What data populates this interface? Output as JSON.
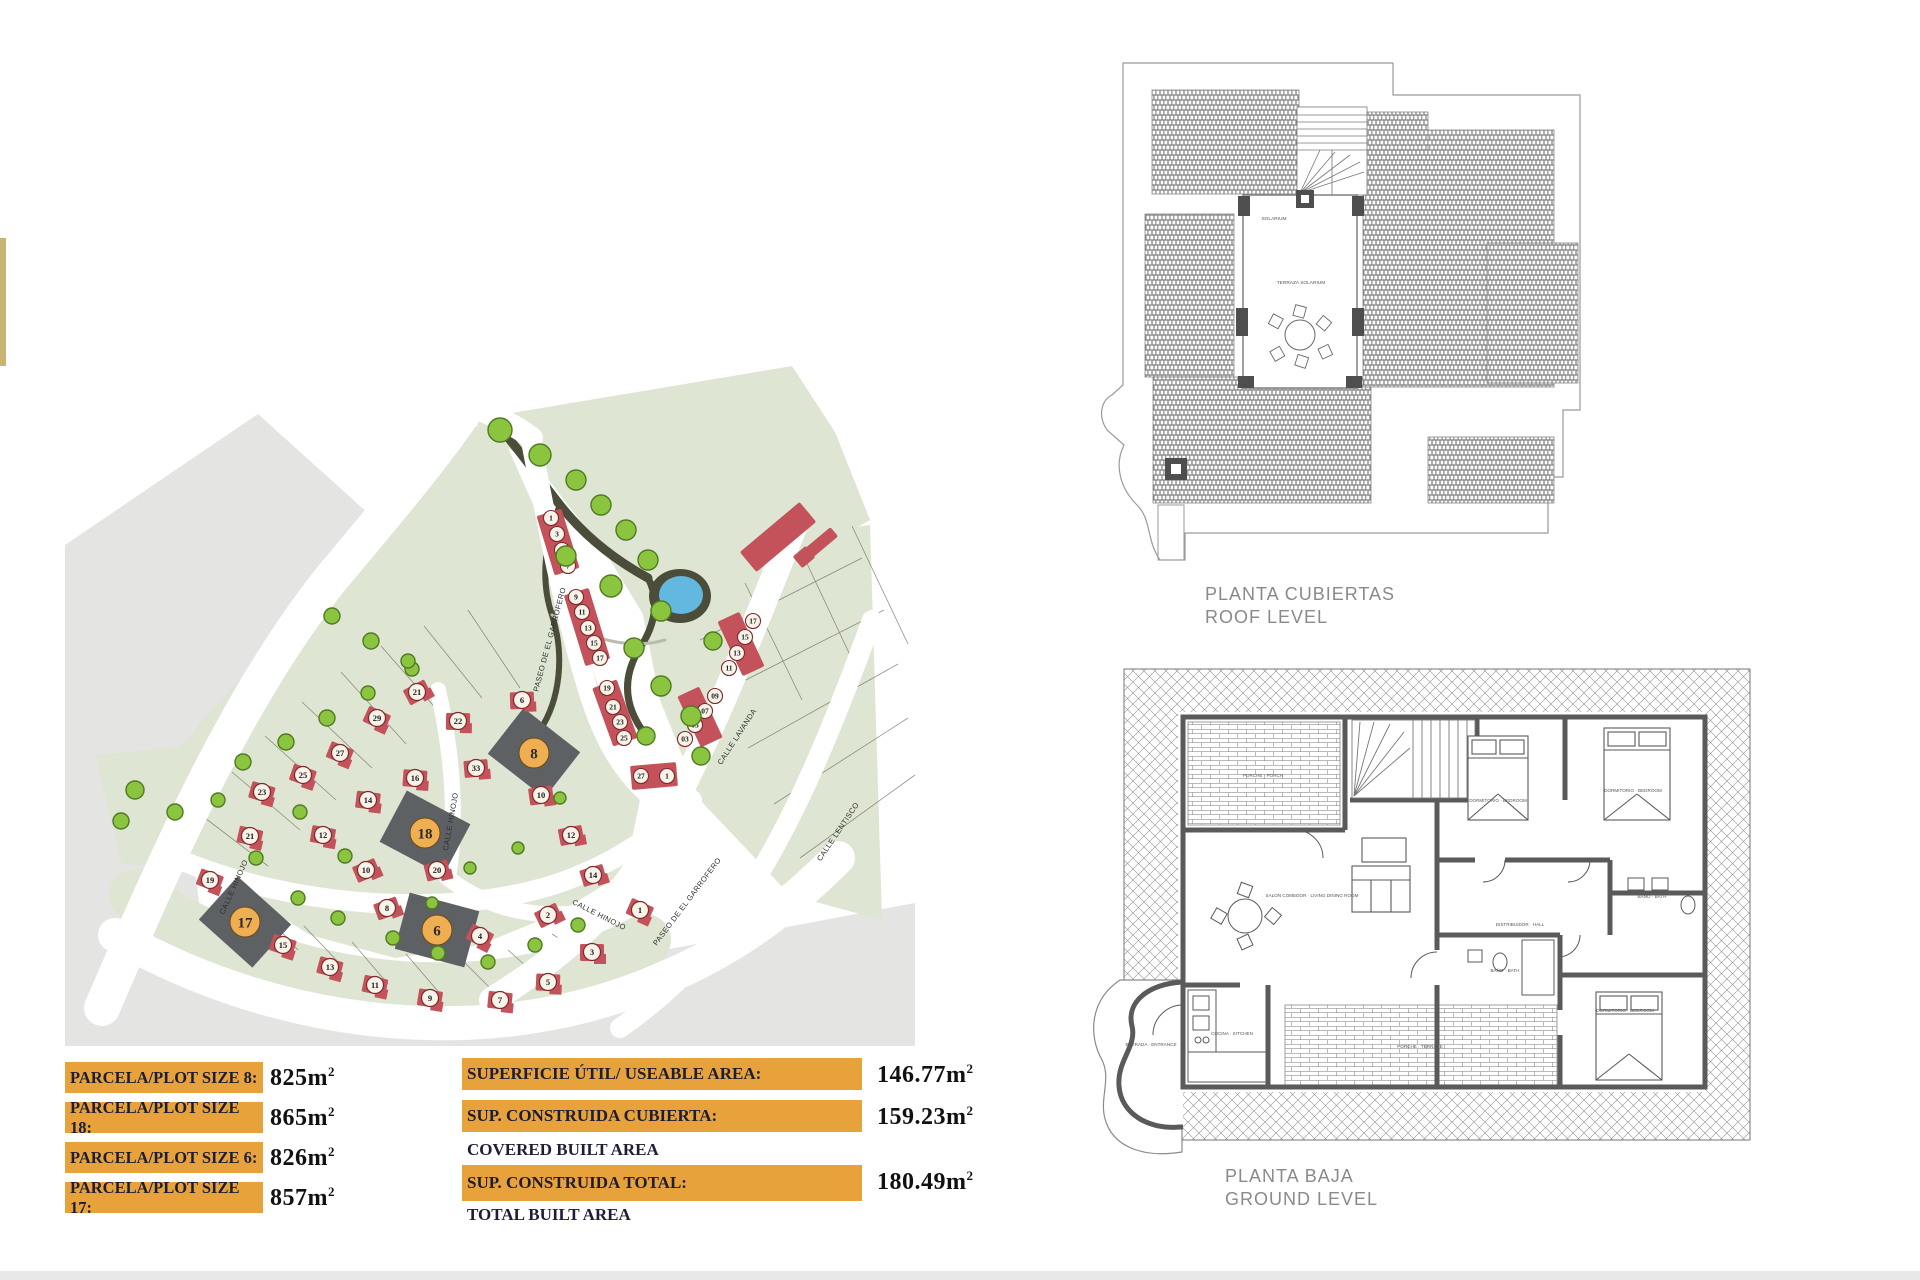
{
  "colors": {
    "terrain_gray": "#e4e4e2",
    "green": "#dee5d2",
    "green_edge": "#c9d2bc",
    "road_white": "#ffffff",
    "house_red": "#c4525a",
    "circle_fill": "#f8f3e9",
    "circle_stroke": "#7c2a2e",
    "highlight_plot": "#5d6164",
    "orange_circle": "#f0ae53",
    "tree": "#8bc53f",
    "tree_stroke": "#4f7a23",
    "park_dark": "#4b4c39",
    "pond_blue": "#62b8df",
    "table_orange": "#e8a23b",
    "plan_line": "#8e8e8e",
    "wall": "#5a5a5a"
  },
  "site_plan": {
    "street_labels": [
      {
        "text": "PASEO DE EL GARROFERO",
        "x": 552,
        "y": 640,
        "rot": -75
      },
      {
        "text": "CALLE HINOJO",
        "x": 453,
        "y": 822,
        "rot": -80
      },
      {
        "text": "CALLE HINOJO",
        "x": 236,
        "y": 888,
        "rot": -66
      },
      {
        "text": "CALLE HINOJO",
        "x": 598,
        "y": 917,
        "rot": 27
      },
      {
        "text": "CALLE LAVANDA",
        "x": 739,
        "y": 738,
        "rot": -57
      },
      {
        "text": "CALLE LENTISCO",
        "x": 840,
        "y": 833,
        "rot": -56
      },
      {
        "text": "PASEO DE EL GARROFERO",
        "x": 689,
        "y": 903,
        "rot": -53
      }
    ],
    "highlight_plots": [
      {
        "n": "8",
        "x": 534,
        "y": 753,
        "rot": 38
      },
      {
        "n": "18",
        "x": 425,
        "y": 833,
        "rot": 28
      },
      {
        "n": "6",
        "x": 437,
        "y": 930,
        "rot": 15
      },
      {
        "n": "17",
        "x": 245,
        "y": 922,
        "rot": 42
      }
    ],
    "townhouse_units": [
      {
        "n": "1",
        "x": 551,
        "y": 518
      },
      {
        "n": "3",
        "x": 557,
        "y": 534
      },
      {
        "n": "5",
        "x": 562,
        "y": 550
      },
      {
        "n": "7",
        "x": 568,
        "y": 566
      },
      {
        "n": "9",
        "x": 576,
        "y": 597
      },
      {
        "n": "11",
        "x": 582,
        "y": 612
      },
      {
        "n": "13",
        "x": 588,
        "y": 628
      },
      {
        "n": "15",
        "x": 594,
        "y": 643
      },
      {
        "n": "17",
        "x": 600,
        "y": 658
      },
      {
        "n": "19",
        "x": 607,
        "y": 688
      },
      {
        "n": "21",
        "x": 613,
        "y": 707
      },
      {
        "n": "23",
        "x": 620,
        "y": 722
      },
      {
        "n": "25",
        "x": 624,
        "y": 738
      },
      {
        "n": "27",
        "x": 641,
        "y": 776
      },
      {
        "n": "1",
        "x": 667,
        "y": 776
      },
      {
        "n": "17",
        "x": 753,
        "y": 621
      },
      {
        "n": "15",
        "x": 745,
        "y": 637
      },
      {
        "n": "13",
        "x": 737,
        "y": 653
      },
      {
        "n": "11",
        "x": 729,
        "y": 668
      },
      {
        "n": "09",
        "x": 715,
        "y": 696
      },
      {
        "n": "07",
        "x": 705,
        "y": 711
      },
      {
        "n": "05",
        "x": 695,
        "y": 725
      },
      {
        "n": "03",
        "x": 685,
        "y": 739
      }
    ],
    "houses": [
      {
        "n": "21",
        "x": 417,
        "y": 692
      },
      {
        "n": "29",
        "x": 377,
        "y": 718
      },
      {
        "n": "27",
        "x": 340,
        "y": 753
      },
      {
        "n": "25",
        "x": 303,
        "y": 775
      },
      {
        "n": "23",
        "x": 262,
        "y": 792
      },
      {
        "n": "21",
        "x": 250,
        "y": 836
      },
      {
        "n": "12",
        "x": 323,
        "y": 835
      },
      {
        "n": "14",
        "x": 368,
        "y": 800
      },
      {
        "n": "16",
        "x": 415,
        "y": 778
      },
      {
        "n": "22",
        "x": 458,
        "y": 721
      },
      {
        "n": "6",
        "x": 522,
        "y": 700
      },
      {
        "n": "33",
        "x": 476,
        "y": 768
      },
      {
        "n": "10",
        "x": 541,
        "y": 795
      },
      {
        "n": "12",
        "x": 571,
        "y": 835
      },
      {
        "n": "20",
        "x": 437,
        "y": 870
      },
      {
        "n": "14",
        "x": 593,
        "y": 875
      },
      {
        "n": "8",
        "x": 387,
        "y": 908
      },
      {
        "n": "10",
        "x": 366,
        "y": 870
      },
      {
        "n": "2",
        "x": 548,
        "y": 915
      },
      {
        "n": "4",
        "x": 480,
        "y": 936
      },
      {
        "n": "1",
        "x": 640,
        "y": 910
      },
      {
        "n": "19",
        "x": 210,
        "y": 880
      },
      {
        "n": "15",
        "x": 283,
        "y": 945
      },
      {
        "n": "13",
        "x": 330,
        "y": 967
      },
      {
        "n": "11",
        "x": 375,
        "y": 985
      },
      {
        "n": "9",
        "x": 430,
        "y": 998
      },
      {
        "n": "7",
        "x": 500,
        "y": 1000
      },
      {
        "n": "5",
        "x": 548,
        "y": 982
      },
      {
        "n": "3",
        "x": 592,
        "y": 952
      }
    ],
    "blocks": [
      {
        "x": 558,
        "y": 542,
        "w": 26,
        "h": 62,
        "r": -17
      },
      {
        "x": 587,
        "y": 627,
        "w": 26,
        "h": 74,
        "r": -17
      },
      {
        "x": 615,
        "y": 713,
        "w": 26,
        "h": 62,
        "r": -20
      },
      {
        "x": 654,
        "y": 776,
        "w": 46,
        "h": 24,
        "r": -5
      },
      {
        "x": 741,
        "y": 644,
        "w": 24,
        "h": 60,
        "r": -25
      },
      {
        "x": 700,
        "y": 717,
        "w": 24,
        "h": 56,
        "r": -25
      },
      {
        "x": 778,
        "y": 537,
        "w": 78,
        "h": 26,
        "r": -40
      },
      {
        "x": 804,
        "y": 557,
        "w": 17,
        "h": 15,
        "r": -40
      },
      {
        "x": 822,
        "y": 542,
        "w": 32,
        "h": 12,
        "r": -40
      }
    ],
    "trees": [
      [
        500,
        430,
        12
      ],
      [
        540,
        455,
        11
      ],
      [
        576,
        480,
        10
      ],
      [
        601,
        505,
        10
      ],
      [
        626,
        530,
        10
      ],
      [
        566,
        556,
        10
      ],
      [
        648,
        560,
        10
      ],
      [
        611,
        586,
        11
      ],
      [
        661,
        611,
        10
      ],
      [
        634,
        648,
        10
      ],
      [
        661,
        686,
        10
      ],
      [
        691,
        716,
        10
      ],
      [
        646,
        736,
        9
      ],
      [
        701,
        756,
        9
      ],
      [
        713,
        641,
        9
      ],
      [
        243,
        762,
        8
      ],
      [
        286,
        742,
        8
      ],
      [
        327,
        718,
        8
      ],
      [
        368,
        693,
        7
      ],
      [
        412,
        669,
        7
      ],
      [
        300,
        812,
        7
      ],
      [
        256,
        858,
        7
      ],
      [
        345,
        856,
        7
      ],
      [
        298,
        898,
        7
      ],
      [
        338,
        918,
        7
      ],
      [
        393,
        938,
        7
      ],
      [
        438,
        953,
        7
      ],
      [
        488,
        962,
        7
      ],
      [
        535,
        945,
        7
      ],
      [
        578,
        925,
        7
      ],
      [
        432,
        903,
        6
      ],
      [
        470,
        868,
        6
      ],
      [
        518,
        848,
        6
      ],
      [
        560,
        798,
        6
      ],
      [
        135,
        790,
        9
      ],
      [
        175,
        812,
        8
      ],
      [
        121,
        821,
        8
      ],
      [
        218,
        800,
        7
      ],
      [
        332,
        616,
        8
      ],
      [
        371,
        641,
        8
      ],
      [
        408,
        661,
        7
      ]
    ]
  },
  "roof_plan": {
    "title_es": "PLANTA CUBIERTAS",
    "title_en": "ROOF LEVEL",
    "room_labels": [
      {
        "text": "SOLARIUM",
        "x": 1274,
        "y": 220
      },
      {
        "text": "TERRAZA SOLARIUM",
        "x": 1301,
        "y": 284
      }
    ]
  },
  "ground_plan": {
    "title_es": "PLANTA BAJA",
    "title_en": "GROUND LEVEL",
    "room_labels": [
      {
        "text": "PORCHE · PORCH",
        "x": 1263,
        "y": 777
      },
      {
        "text": "SALON COMEDOR · LIVING DINING ROOM",
        "x": 1312,
        "y": 897
      },
      {
        "text": "COCINA · KITCHEN",
        "x": 1232,
        "y": 1035
      },
      {
        "text": "ENTRADA · ENTRANCE",
        "x": 1151,
        "y": 1046
      },
      {
        "text": "DORMITORIO · BEDROOM",
        "x": 1498,
        "y": 802
      },
      {
        "text": "DORMITORIO · BEDROOM",
        "x": 1633,
        "y": 792
      },
      {
        "text": "BAÑO · BATH",
        "x": 1652,
        "y": 898
      },
      {
        "text": "BAÑO · BATH",
        "x": 1505,
        "y": 972
      },
      {
        "text": "DISTRIBUIDOR · HALL",
        "x": 1520,
        "y": 926
      },
      {
        "text": "DORMITORIO · BEDROOM",
        "x": 1625,
        "y": 1012
      },
      {
        "text": "PORCHE · TERRACE",
        "x": 1420,
        "y": 1048
      }
    ]
  },
  "plot_table": {
    "unit": "m",
    "sup": "2",
    "rows": [
      {
        "label": "PARCELA/PLOT SIZE 8:",
        "value": "825"
      },
      {
        "label": "PARCELA/PLOT SIZE 18:",
        "value": "865"
      },
      {
        "label": "PARCELA/PLOT SIZE 6:",
        "value": "826"
      },
      {
        "label": "PARCELA/PLOT SIZE 17:",
        "value": "857"
      }
    ]
  },
  "area_table": {
    "unit": "m",
    "sup": "2",
    "rows": [
      {
        "label": "SUPERFICIE ÚTIL/ USEABLE AREA:",
        "sub": "",
        "value": "146.77"
      },
      {
        "label": "SUP. CONSTRUIDA CUBIERTA:",
        "sub": "COVERED BUILT AREA",
        "value": "159.23"
      },
      {
        "label": "SUP. CONSTRUIDA TOTAL:",
        "sub": "TOTAL BUILT AREA",
        "value": "180.49"
      }
    ]
  }
}
